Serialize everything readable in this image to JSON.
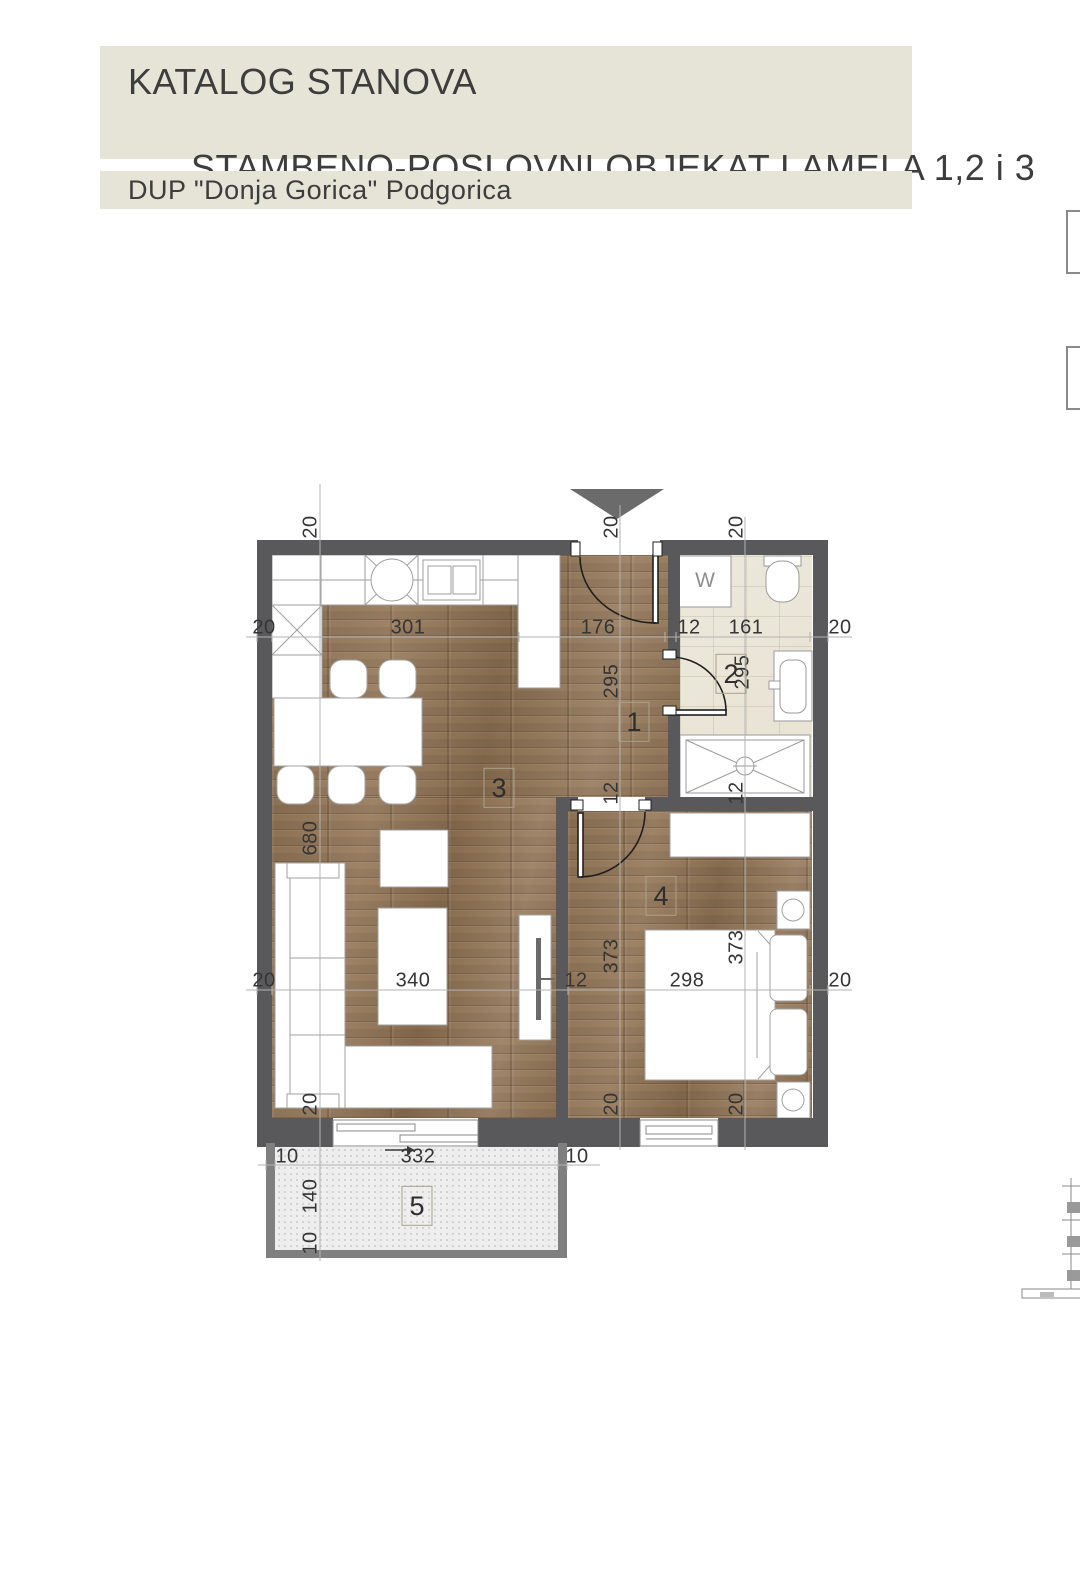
{
  "header": {
    "title_line1": "KATALOG STANOVA",
    "title_line2": "STAMBENO-POSLOVNI OBJEKAT LAMELA 1,2 i 3",
    "subtitle": "DUP \"Donja Gorica\" Podgorica"
  },
  "plan": {
    "rooms": [
      {
        "number": "1"
      },
      {
        "number": "2"
      },
      {
        "number": "3"
      },
      {
        "number": "4"
      },
      {
        "number": "5"
      }
    ],
    "washer_label": "W",
    "dims_h_top": [
      "20",
      "301",
      "176",
      "12",
      "161",
      "20"
    ],
    "dims_h_mid": [
      "20",
      "340",
      "12",
      "298",
      "20"
    ],
    "dims_h_balcony": [
      "10",
      "332",
      "10"
    ],
    "dims_v_left": [
      "20",
      "680",
      "20",
      "140",
      "10"
    ],
    "dims_v_mid": [
      "20",
      "295",
      "12",
      "373",
      "20"
    ],
    "dims_v_right": [
      "20",
      "295",
      "12",
      "373",
      "20"
    ],
    "colors": {
      "wall": "#59595b",
      "balcony_wall": "#7f7f7f",
      "wood_floor": "#95785a",
      "bathroom_floor": "#ebe7da",
      "balcony_floor": "#eeeeee",
      "header_band": "#e5e4d7",
      "entrance_marker": "#6b6b6b"
    }
  }
}
